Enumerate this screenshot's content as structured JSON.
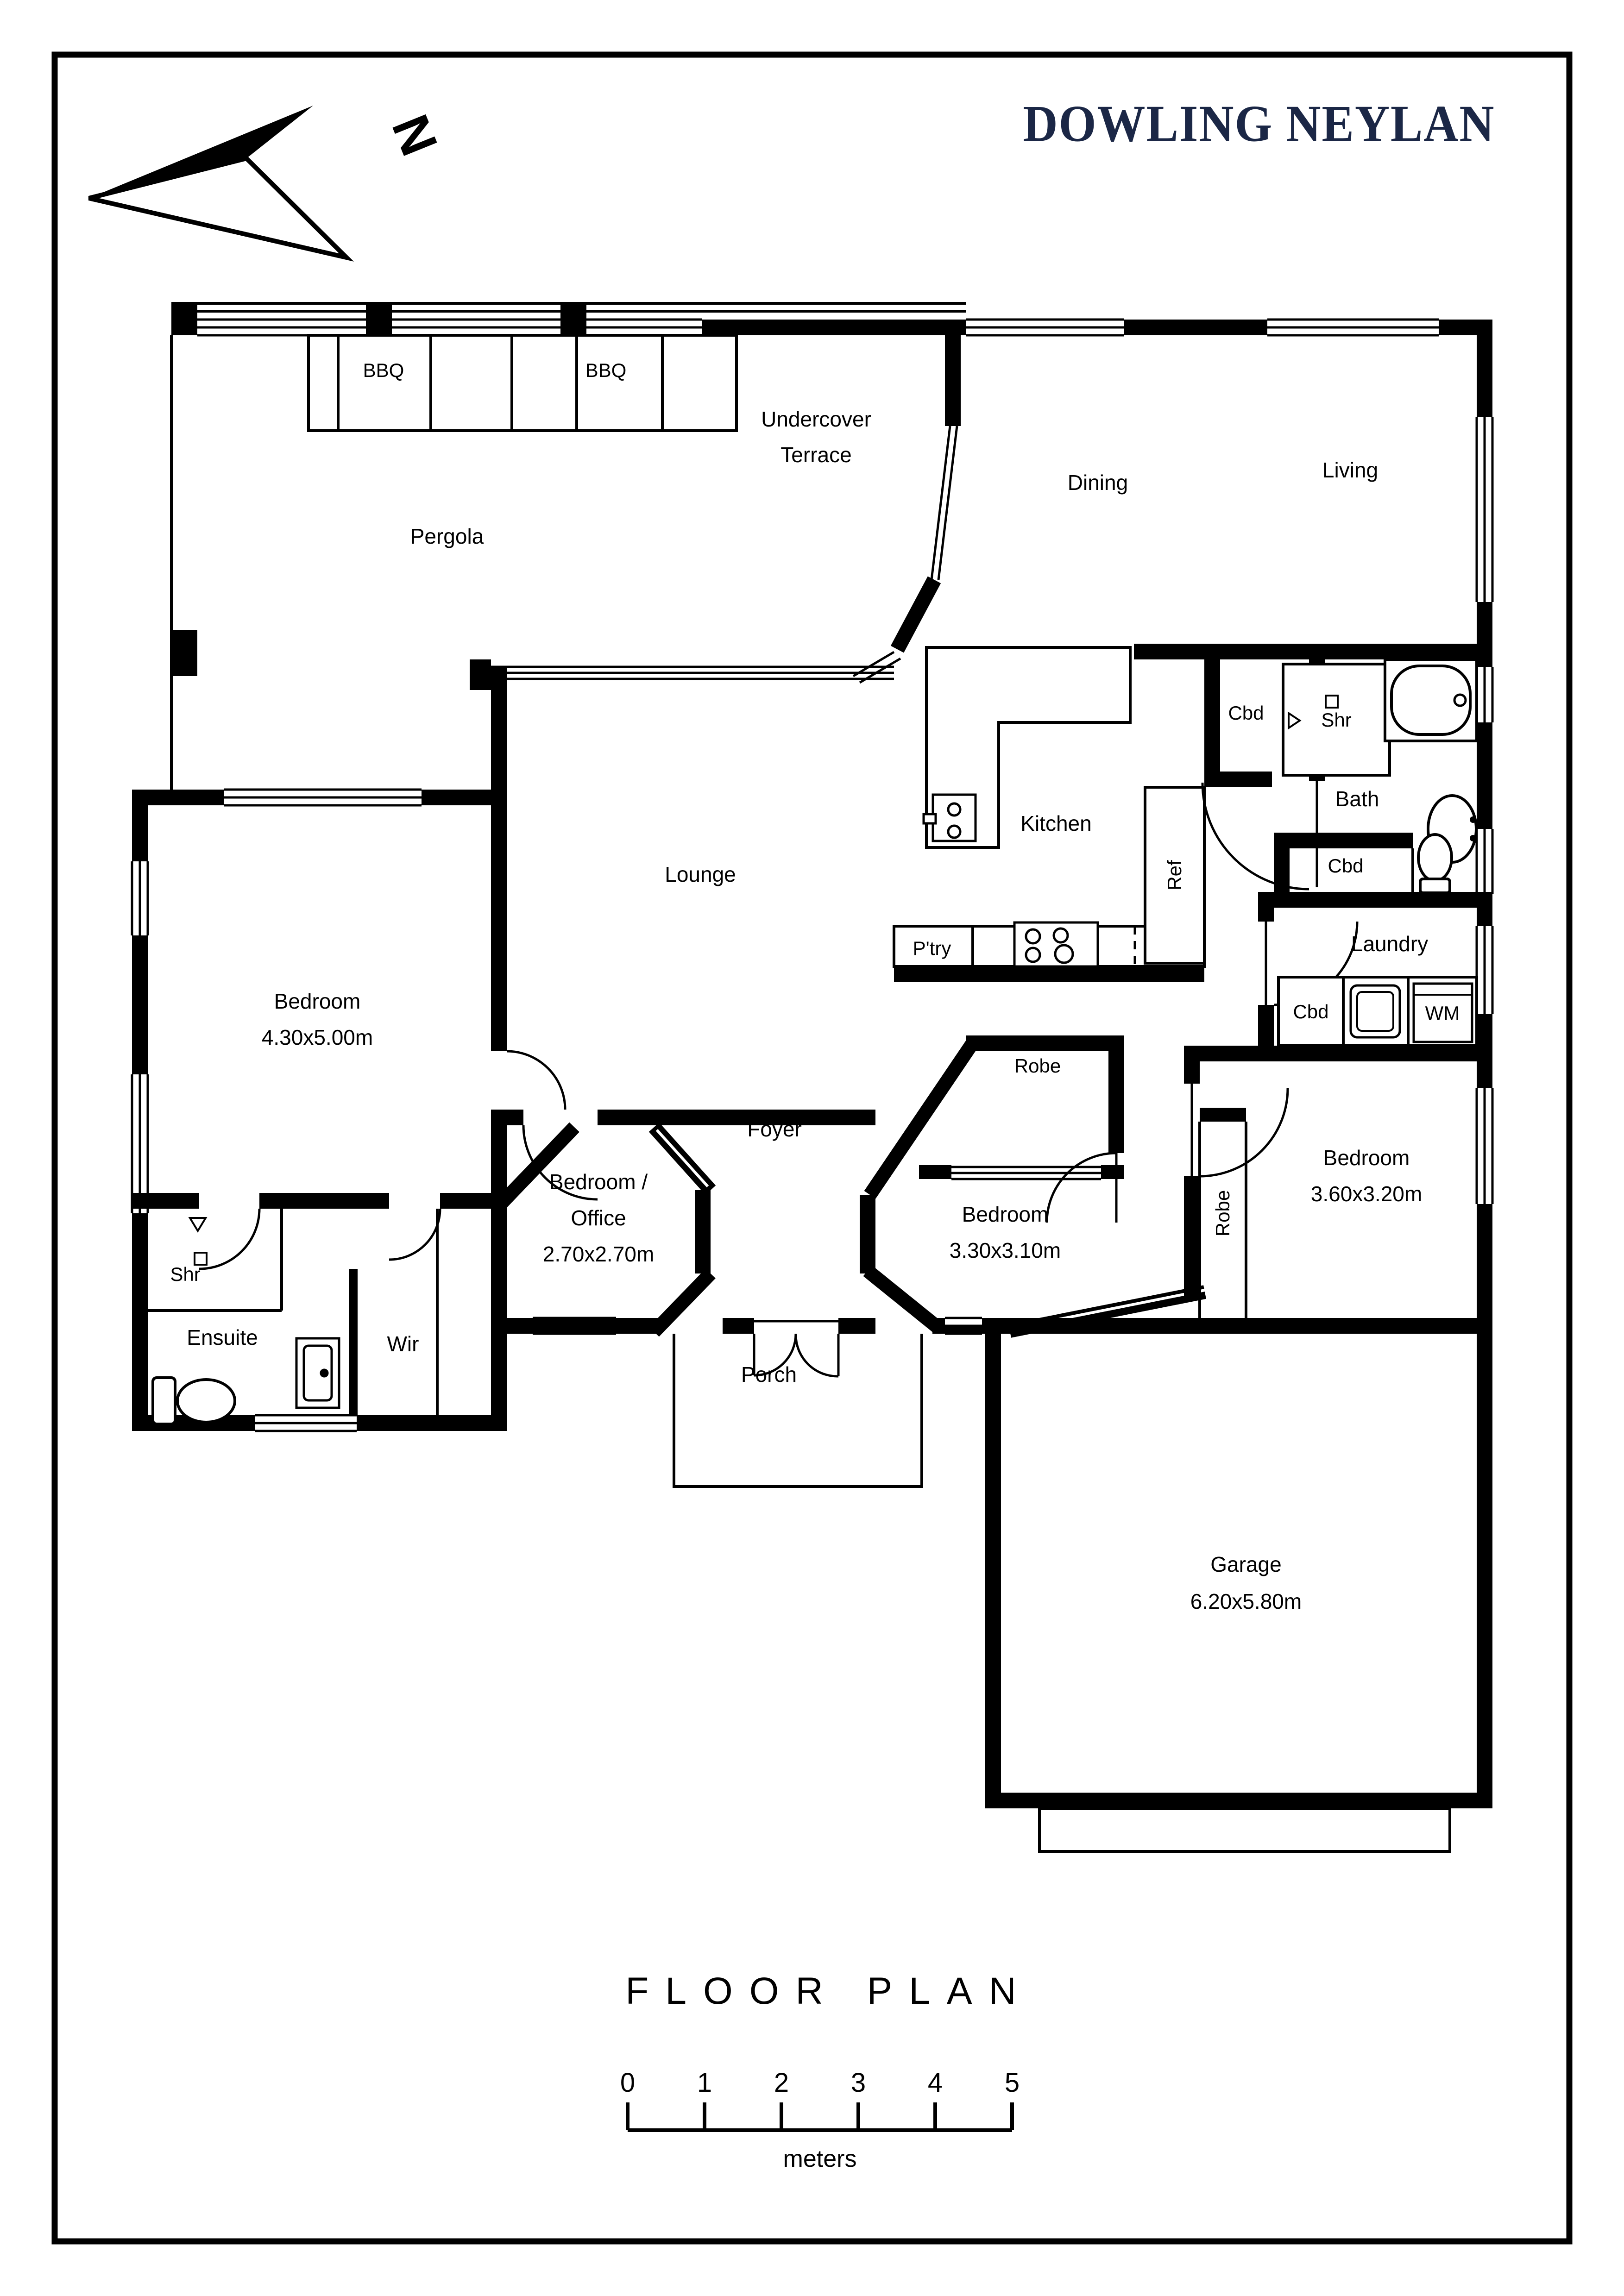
{
  "page": {
    "background": "#ffffff",
    "wall_color": "#000000",
    "brand_color": "#1b2746"
  },
  "header": {
    "brand": "DOWLING NEYLAN",
    "compass": "N"
  },
  "labels": {
    "bbq_left": "BBQ",
    "bbq_right": "BBQ",
    "terrace_line1": "Undercover",
    "terrace_line2": "Terrace",
    "pergola": "Pergola",
    "dining": "Dining",
    "living": "Living",
    "kitchen": "Kitchen",
    "pantry": "P'try",
    "fridge": "Ref",
    "cbd_kitchen": "Cbd",
    "cbd_bath": "Cbd",
    "cbd_laundry": "Cbd",
    "shower_bath": "Shr",
    "bath": "Bath",
    "laundry": "Laundry",
    "washing_machine": "WM",
    "lounge": "Lounge",
    "bedroom1_name": "Bedroom",
    "bedroom1_size": "4.30x5.00m",
    "robe_bedroom2": "Robe",
    "bedroom2_name": "Bedroom",
    "bedroom2_size": "3.30x3.10m",
    "robe_bedroom3": "Robe",
    "bedroom3_name": "Bedroom",
    "bedroom3_size": "3.60x3.20m",
    "office_line1": "Bedroom /",
    "office_line2": "Office",
    "office_line3": "2.70x2.70m",
    "foyer": "Foyer",
    "porch": "Porch",
    "shower_ensuite": "Shr",
    "ensuite": "Ensuite",
    "wir": "Wir",
    "garage_name": "Garage",
    "garage_size": "6.20x5.80m"
  },
  "footer": {
    "title": "FLOOR PLAN",
    "scale_unit": "meters",
    "scale_ticks": [
      "0",
      "1",
      "2",
      "3",
      "4",
      "5"
    ]
  }
}
